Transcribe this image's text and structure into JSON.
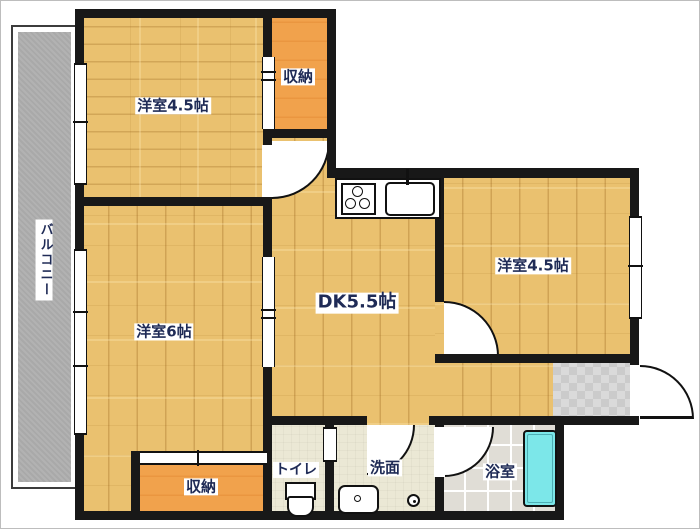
{
  "floorplan": {
    "type": "apartment-floor-plan",
    "labels": {
      "room_top_left": "洋室4.5帖",
      "closet_top": "収納",
      "room_right": "洋室4.5帖",
      "dining_kitchen": "DK5.5帖",
      "room_left": "洋室6帖",
      "closet_bottom": "収納",
      "toilet": "トイレ",
      "washroom": "洗面",
      "bathroom": "浴室",
      "balcony": "バルコニー"
    },
    "rooms": [
      {
        "name": "洋室4.5帖",
        "type": "western_room",
        "size_tatami": 4.5
      },
      {
        "name": "洋室6帖",
        "type": "western_room",
        "size_tatami": 6
      },
      {
        "name": "洋室4.5帖",
        "type": "western_room",
        "size_tatami": 4.5
      },
      {
        "name": "DK5.5帖",
        "type": "dining_kitchen",
        "size_tatami": 5.5
      },
      {
        "name": "収納",
        "type": "storage"
      },
      {
        "name": "収納",
        "type": "storage"
      },
      {
        "name": "トイレ",
        "type": "toilet"
      },
      {
        "name": "洗面",
        "type": "washroom"
      },
      {
        "name": "浴室",
        "type": "bathroom"
      },
      {
        "name": "バルコニー",
        "type": "balcony"
      }
    ],
    "fixtures": [
      "stove-icon",
      "sink-icon",
      "faucet-icon",
      "toilet-icon",
      "washbasin-icon",
      "washer-drain-icon",
      "bathtub-icon",
      "door-swing-icon",
      "sliding-door-icon",
      "window-icon"
    ],
    "colors": {
      "wall": "#181818",
      "wood_floor": "#eac16f",
      "storage": "#f1a24c",
      "service_floor": "#ebe8d5",
      "bath_tile": "#e0ddd6",
      "genkan_tile": "#d6d6d6",
      "bathtub": "#7ce7e9",
      "balcony": "#a9a9a9",
      "label_text": "#1f2b56",
      "background": "#ffffff"
    }
  }
}
